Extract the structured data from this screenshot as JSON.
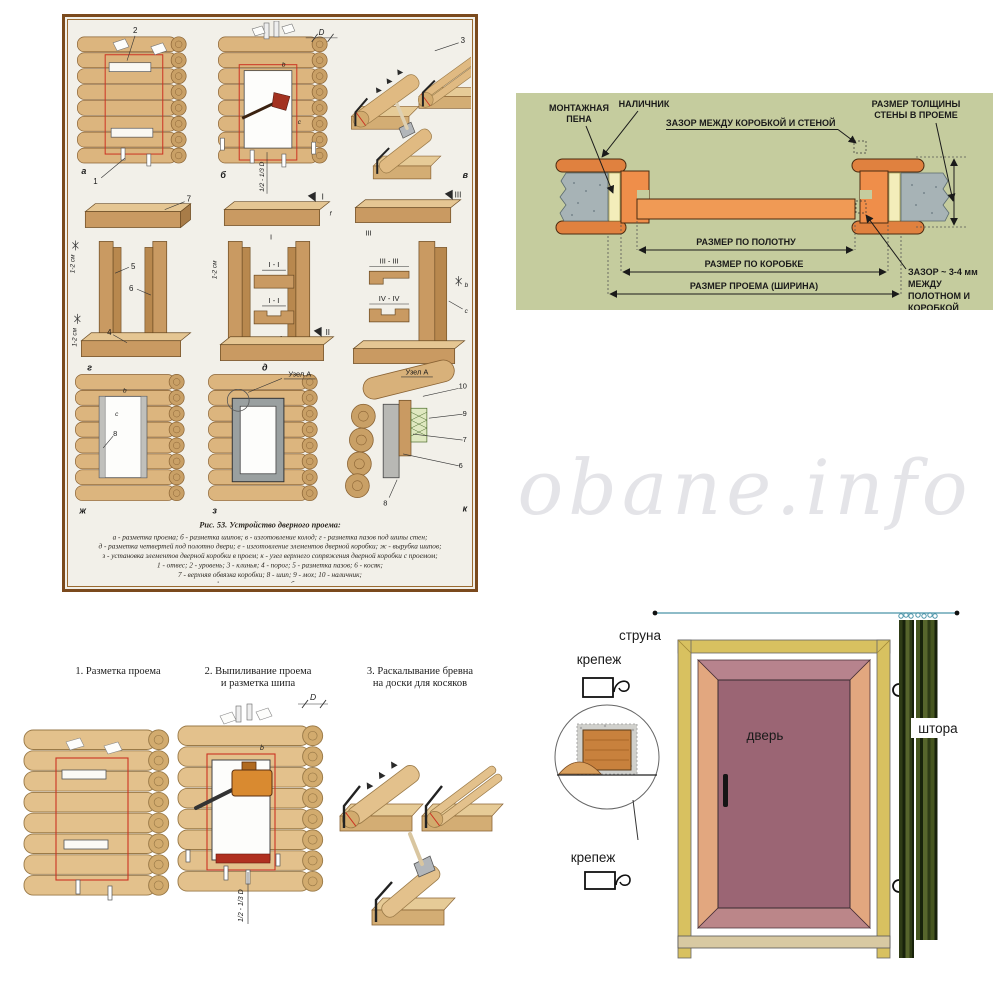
{
  "page": {
    "watermark": "obane.info"
  },
  "colors": {
    "section_bg": "#c5cc9e",
    "frame_orange": "#ef8e4a",
    "leaf_orange": "#f09a55",
    "trim_orange": "#e0813f",
    "door_leaf": "#9b6574",
    "door_frame_yellow": "#d8c160",
    "curtain_dark": "#2f3c16",
    "string_line": "#4a93a8",
    "marking_red": "#cc3322",
    "log_wood": "#dcb57e"
  },
  "fig53": {
    "caption_title": "Рис. 53. Устройство дверного проема:",
    "caption_lines": [
      "а - разметка проема; б - разметка шипов; в - изготовление колод; г - разметка пазов под шипы стен;",
      "д - разметка четвертей под полотно двери; е - изготовление элементов дверной коробки; ж - вырубка шипов;",
      "з - установка элементов дверной коробки в проем; к - узел верхнего сопряжения дверной коробки с проемом;",
      "1 - отвес; 2 - уровень; 3 - клинья; 4 - порог; 5 - разметка пазов; 6 - косяк;",
      "7 - верхняя обвязка коробки; 8 - шип; 9 - мох; 10 - наличник;",
      "b - ширина шипа; с - глубина шипа"
    ],
    "labels": {
      "a": "а",
      "b": "б",
      "v": "в",
      "g": "г",
      "d": "д",
      "e": "е",
      "zh": "ж",
      "z": "з",
      "k": "к",
      "n1": "1",
      "n2": "2",
      "n3": "3",
      "n4": "4",
      "n5": "5",
      "n6": "6",
      "n7": "7",
      "n8": "8",
      "n9": "9",
      "n10": "10",
      "uzel_a": "Узел А",
      "rom_i": "I",
      "rom_ii": "II",
      "rom_iii": "III",
      "rom_iv": "IV",
      "sec_i": "I - I",
      "sec_iii": "III - III",
      "sec_iv": "IV - IV",
      "dim_12": "1-2 см",
      "dim_d": "D",
      "dim_half": "1/2 - 1/3 D",
      "dim_b": "b",
      "dim_c": "c",
      "dim_f": "f",
      "formula": "в = c + f"
    }
  },
  "section_diagram": {
    "labels": {
      "foam1": "МОНТАЖНАЯ",
      "foam2": "ПЕНА",
      "trim": "НАЛИЧНИК",
      "gap_wall": "ЗАЗОР МЕЖДУ КОРОБКОЙ И СТЕНОЙ",
      "thick1": "РАЗМЕР ТОЛЩИНЫ",
      "thick2": "СТЕНЫ В ПРОЕМЕ",
      "dim_leaf": "РАЗМЕР ПО ПОЛОТНУ",
      "dim_frame": "РАЗМЕР ПО КОРОБКЕ",
      "dim_opening": "РАЗМЕР ПРОЕМА (ШИРИНА)",
      "gap_leaf1": "ЗАЗОР ~ 3-4 мм",
      "gap_leaf2": "МЕЖДУ",
      "gap_leaf3": "ПОЛОТНОМ И",
      "gap_leaf4": "КОРОБКОЙ"
    }
  },
  "steps": {
    "step1": "1. Разметка проема",
    "step2_line1": "2. Выпиливание проема",
    "step2_line2": "и разметка шипа",
    "step3_line1": "3. Раскалывание бревна",
    "step3_line2": "на доски для косяков",
    "dim_d": "D",
    "dim_half": "1/2 - 1/3 D",
    "dim_b": "b"
  },
  "door_diagram": {
    "string": "струна",
    "fastener_top": "крепеж",
    "fastener_bottom": "крепеж",
    "door": "дверь",
    "curtain": "штора"
  }
}
